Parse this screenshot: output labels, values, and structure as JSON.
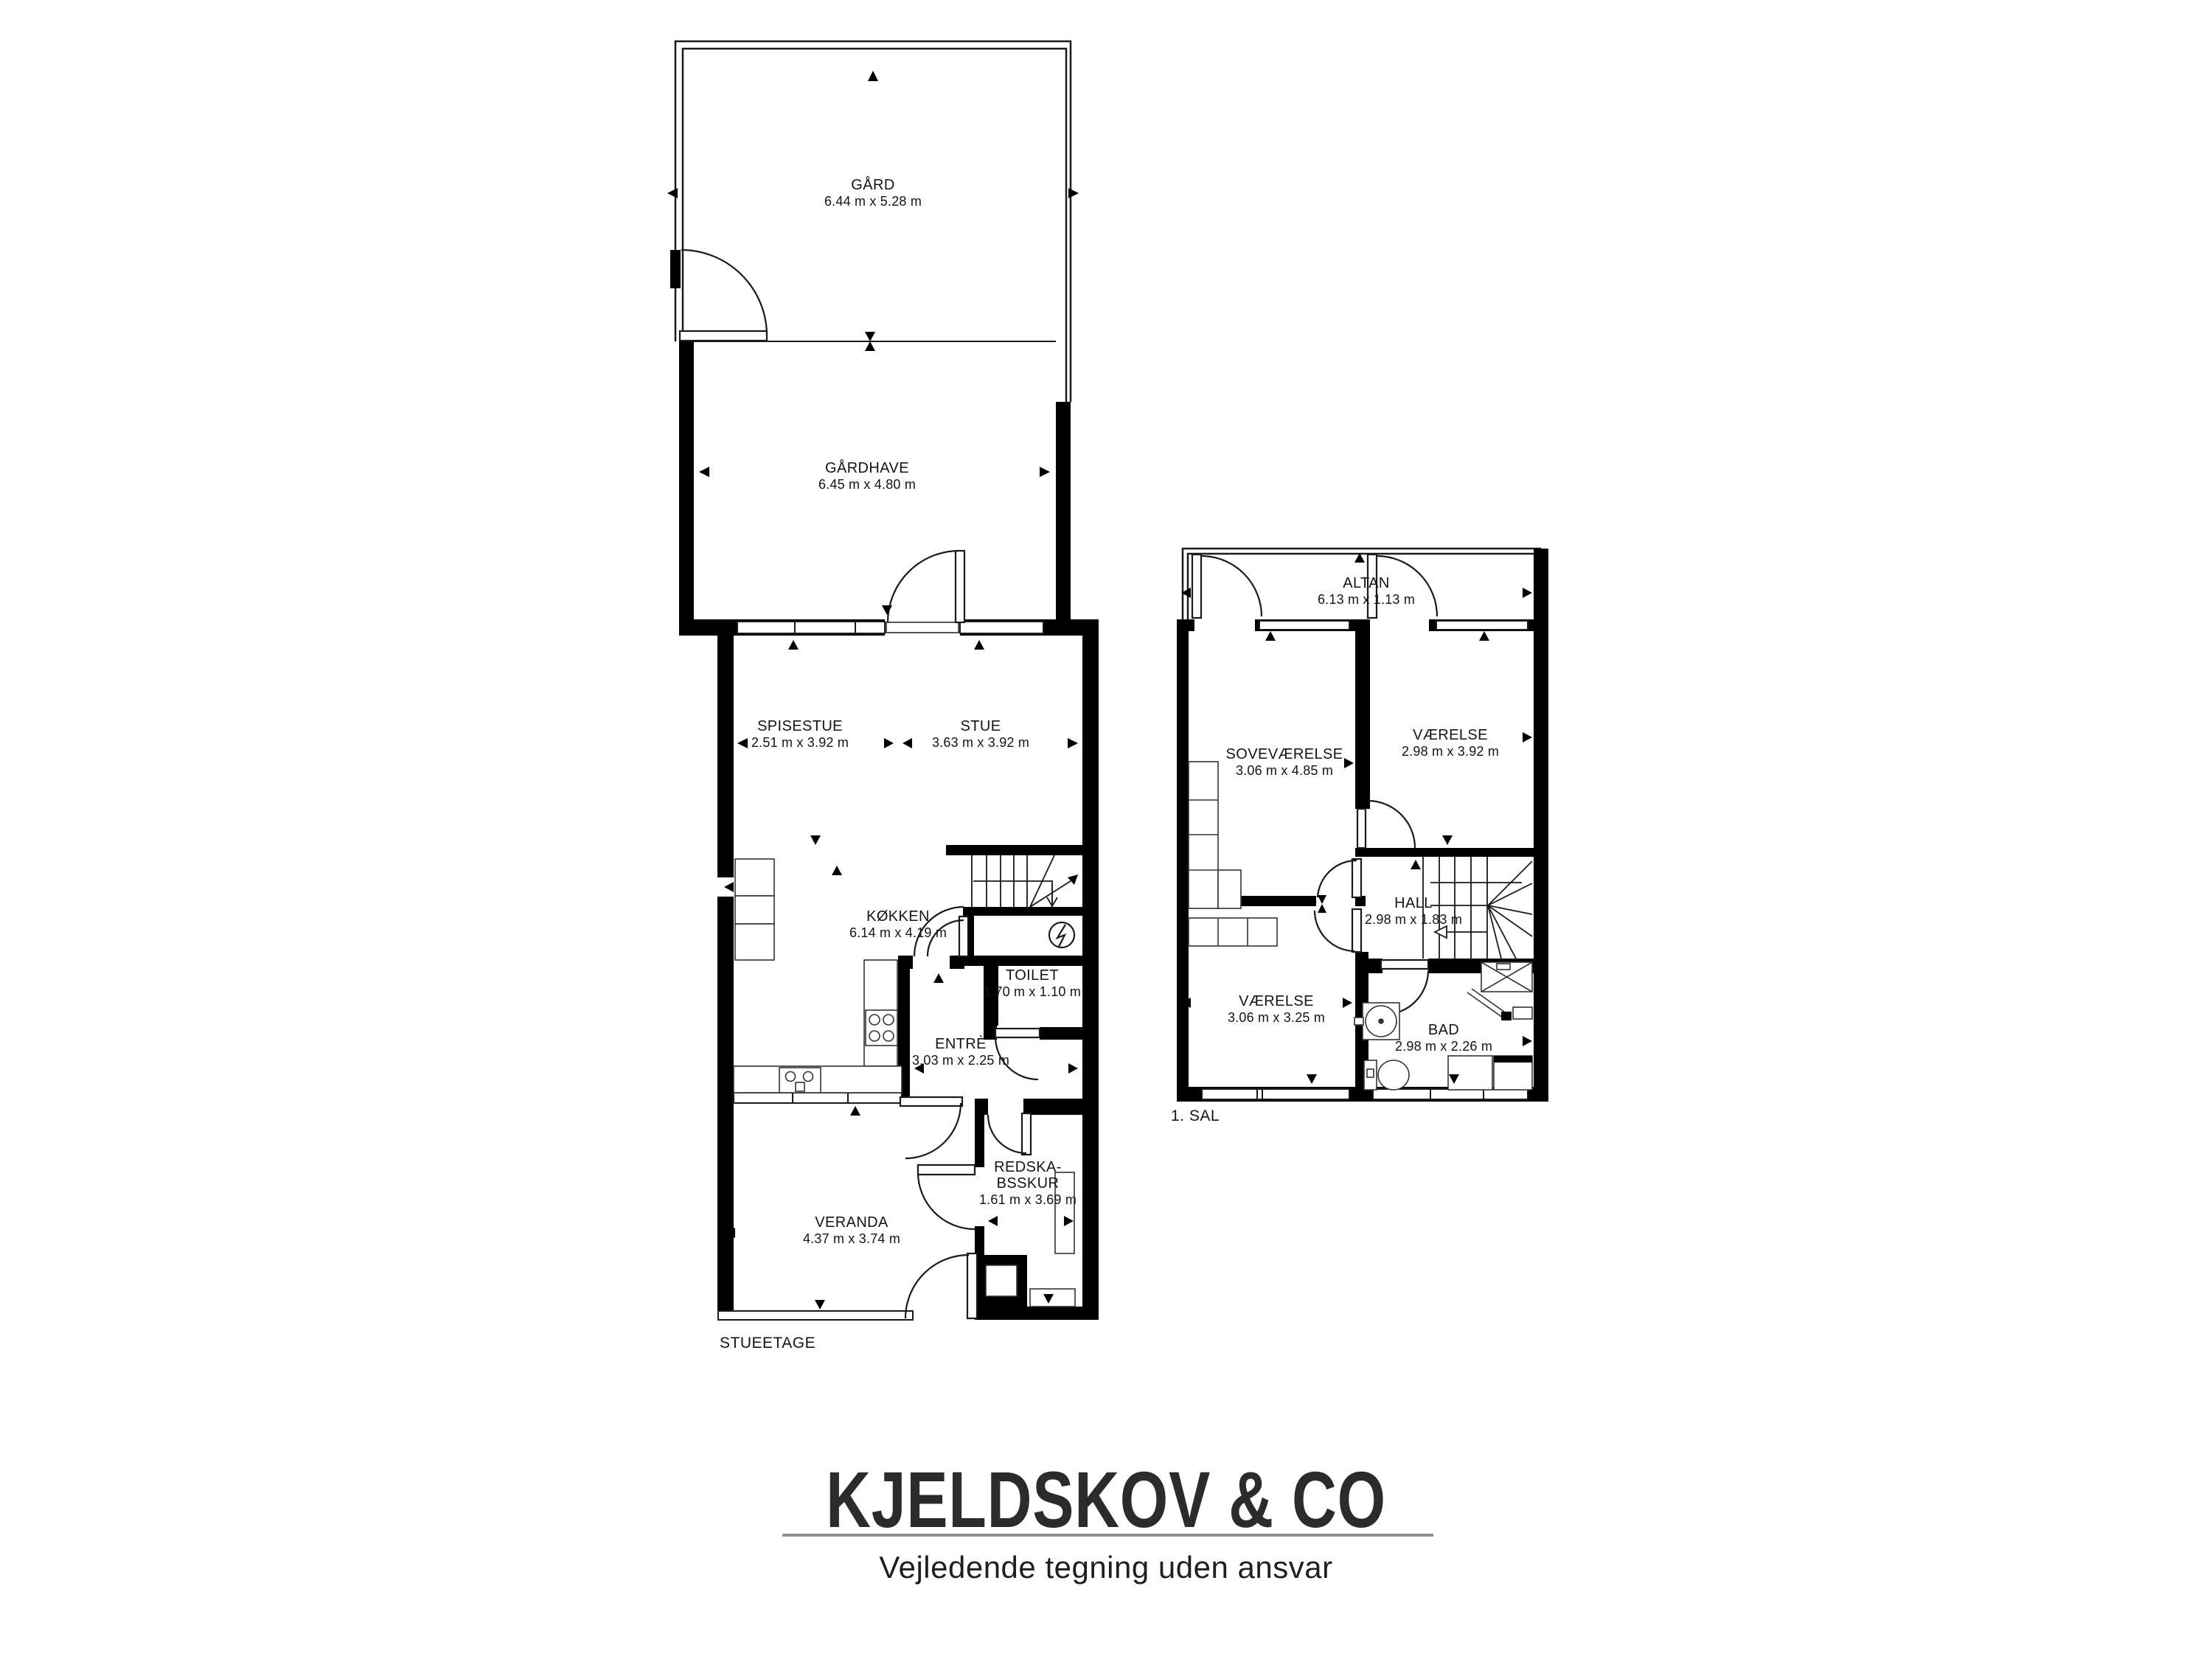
{
  "colors": {
    "wall": "#000000",
    "line": "#1a1a1a",
    "logo": "#2b2b2b",
    "divider_line": "#919191",
    "background": "#ffffff"
  },
  "floors": {
    "ground": {
      "caption": "STUEETAGE",
      "rooms": {
        "gaard": {
          "name": "GÅRD",
          "dims": "6.44 m x 5.28 m"
        },
        "gaardhave": {
          "name": "GÅRDHAVE",
          "dims": "6.45 m x 4.80 m"
        },
        "spisestue": {
          "name": "SPISESTUE",
          "dims": "2.51 m x 3.92 m"
        },
        "stue": {
          "name": "STUE",
          "dims": "3.63 m x 3.92 m"
        },
        "koekken": {
          "name": "KØKKEN",
          "dims": "6.14 m x 4.19 m"
        },
        "toilet": {
          "name": "TOILET",
          "dims": "1.70 m x 1.10 m"
        },
        "entre": {
          "name": "ENTRÈ",
          "dims": "3.03 m x 2.25 m"
        },
        "veranda": {
          "name": "VERANDA",
          "dims": "4.37 m x 3.74 m"
        },
        "redskabsskur": {
          "name_line1": "REDSKA-",
          "name_line2": "BSSKUR",
          "dims": "1.61 m x 3.69 m"
        }
      }
    },
    "first": {
      "caption": "1. SAL",
      "rooms": {
        "altan": {
          "name": "ALTAN",
          "dims": "6.13 m x 1.13 m"
        },
        "sovevaerelse": {
          "name": "SOVEVÆRELSE",
          "dims": "3.06 m x 4.85 m"
        },
        "vaerelse_top": {
          "name": "VÆRELSE",
          "dims": "2.98 m x 3.92 m"
        },
        "hall": {
          "name": "HALL",
          "dims": "2.98 m x 1.83 m"
        },
        "vaerelse_bottom": {
          "name": "VÆRELSE",
          "dims": "3.06 m x 3.25 m"
        },
        "bad": {
          "name": "BAD",
          "dims": "2.98 m x 2.26 m"
        }
      }
    }
  },
  "footer": {
    "brand": "KJELDSKOV & CO",
    "tagline": "Vejledende tegning uden ansvar"
  }
}
